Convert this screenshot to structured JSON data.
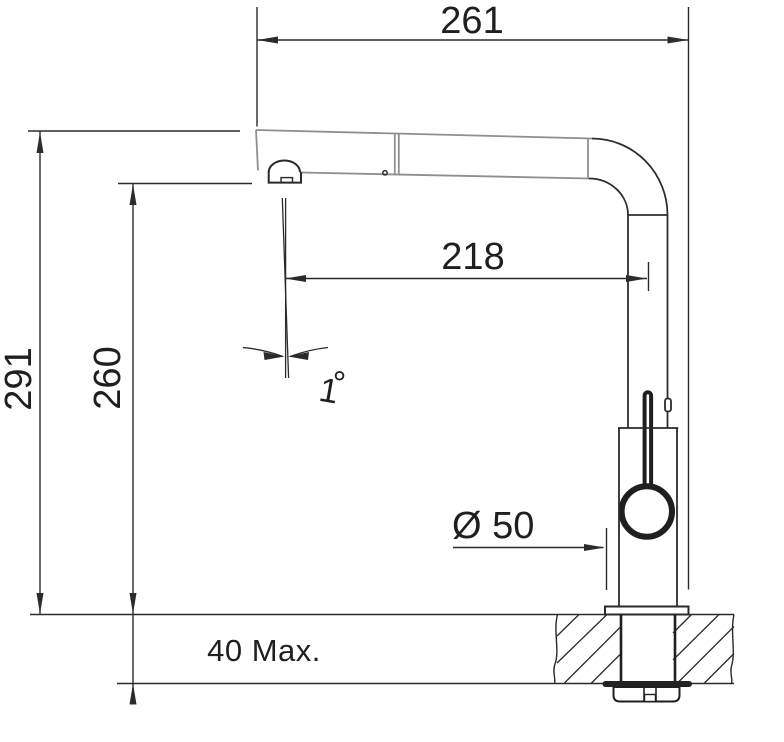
{
  "drawing": {
    "kind": "technical installation drawing of a pull-out kitchen faucet (side view, countertop cross-section)",
    "dimensions": {
      "overall_reach": "261",
      "aerator_reach": "218",
      "overall_height": "291",
      "aerator_height": "260",
      "tilt_angle_value": "1",
      "tilt_angle_unit": "°",
      "base_diameter": "Ø 50",
      "max_counter_thickness": "40 Max."
    },
    "colors": {
      "background": "#ffffff",
      "dimension_lines": "#2b2b2b",
      "faucet_outline": "#2a2a2a",
      "spout_outline": "#8f8f8f",
      "text": "#1f1f1f",
      "washer_fill": "#222222"
    }
  }
}
